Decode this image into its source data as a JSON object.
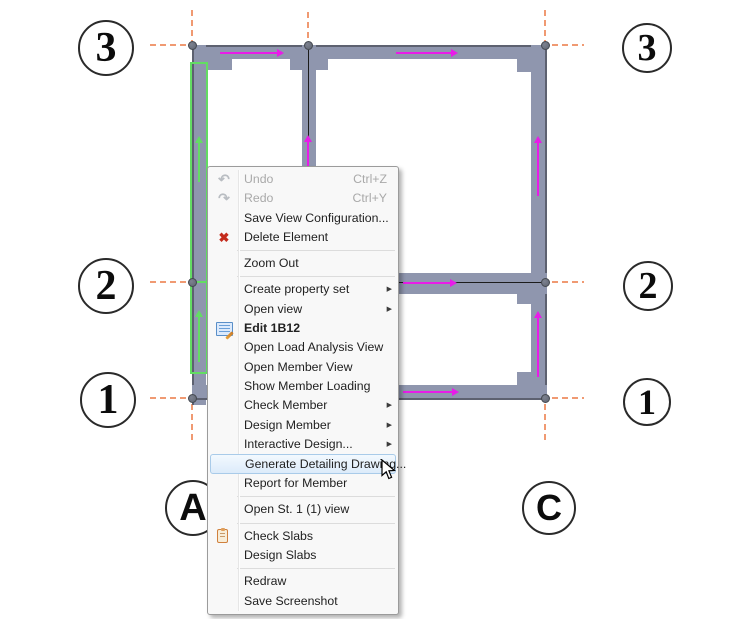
{
  "colors": {
    "wall": "#8f96ae",
    "wall-edge": "#5d6170",
    "grid": "#f09a72",
    "flow": "#e81ce8",
    "selection": "#63dd63",
    "node": "#5f6470",
    "bubble-stroke": "#2a2a2a",
    "hover-border": "#a9cbe9",
    "delete-red": "#c42b1c",
    "disabled": "#a9a9a9"
  },
  "icons": {
    "undo": "↶",
    "redo": "↷",
    "delete": "✖",
    "submenu_arrow": "▶"
  },
  "plan": {
    "selected_element": "1B12",
    "bubbles": [
      {
        "label": "3"
      },
      {
        "label": "3"
      },
      {
        "label": "2"
      },
      {
        "label": "2"
      },
      {
        "label": "1"
      },
      {
        "label": "1"
      },
      {
        "label": "A"
      },
      {
        "label": "C"
      }
    ]
  },
  "context_menu": {
    "items": [
      {
        "label": "Undo",
        "shortcut": "Ctrl+Z",
        "state": "disabled",
        "icon": "undo-icon"
      },
      {
        "label": "Redo",
        "shortcut": "Ctrl+Y",
        "state": "disabled",
        "icon": "redo-icon"
      },
      {
        "label": "Save View Configuration..."
      },
      {
        "label": "Delete Element",
        "icon": "delete-icon"
      },
      {
        "label": "Zoom Out"
      },
      {
        "label": "Create property set",
        "submenu": true
      },
      {
        "label": "Open view",
        "submenu": true
      },
      {
        "label": "Edit 1B12",
        "bold": true,
        "icon": "edit-icon"
      },
      {
        "label": "Open Load Analysis View"
      },
      {
        "label": "Open Member View"
      },
      {
        "label": "Show Member Loading"
      },
      {
        "label": "Check Member",
        "submenu": true
      },
      {
        "label": "Design Member",
        "submenu": true
      },
      {
        "label": "Interactive Design...",
        "submenu": true
      },
      {
        "label": "Generate Detailing Drawing...",
        "state": "hover"
      },
      {
        "label": "Report for Member"
      },
      {
        "label": "Open St. 1 (1) view"
      },
      {
        "label": "Check Slabs",
        "icon": "clipboard-icon"
      },
      {
        "label": "Design Slabs"
      },
      {
        "label": "Redraw"
      },
      {
        "label": "Save Screenshot"
      }
    ]
  }
}
